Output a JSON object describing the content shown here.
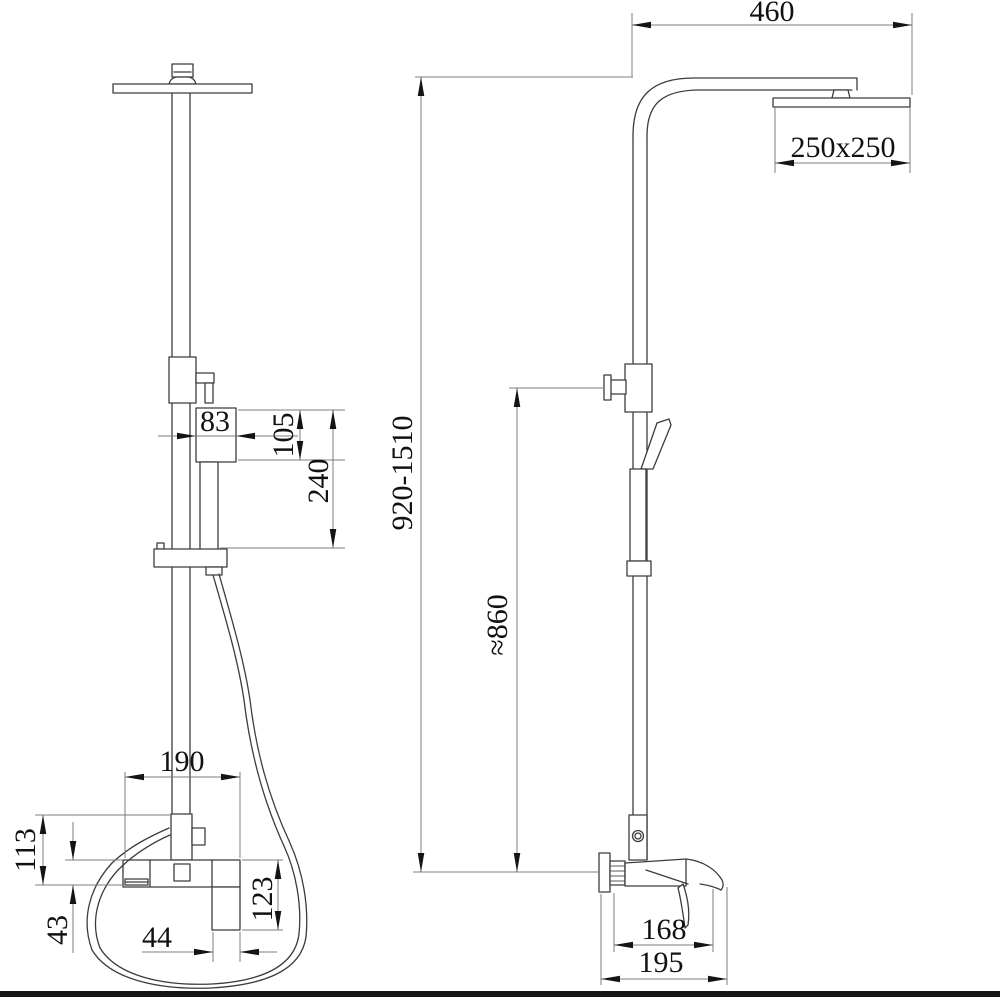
{
  "front_view": {
    "dims": {
      "hand_shower_width": "83",
      "hand_shower_head_height": "105",
      "hand_shower_length": "240",
      "mixer_width": "190",
      "mixer_height": "113",
      "spout_body_height": "43",
      "handle_width": "44",
      "mixer_drop": "123"
    }
  },
  "side_view": {
    "dims": {
      "arm_reach": "460",
      "head_size": "250x250",
      "column_height": "920-1510",
      "hose_height": "≈860",
      "depth_to_spout": "168",
      "total_depth": "195"
    }
  },
  "colors": {
    "drawing_line": "#3c3c3c",
    "dimension_line": "#7d7d7d",
    "arrow": "#141414",
    "text": "#111111",
    "bottom_bar": "#161616",
    "background": "#ffffff"
  }
}
